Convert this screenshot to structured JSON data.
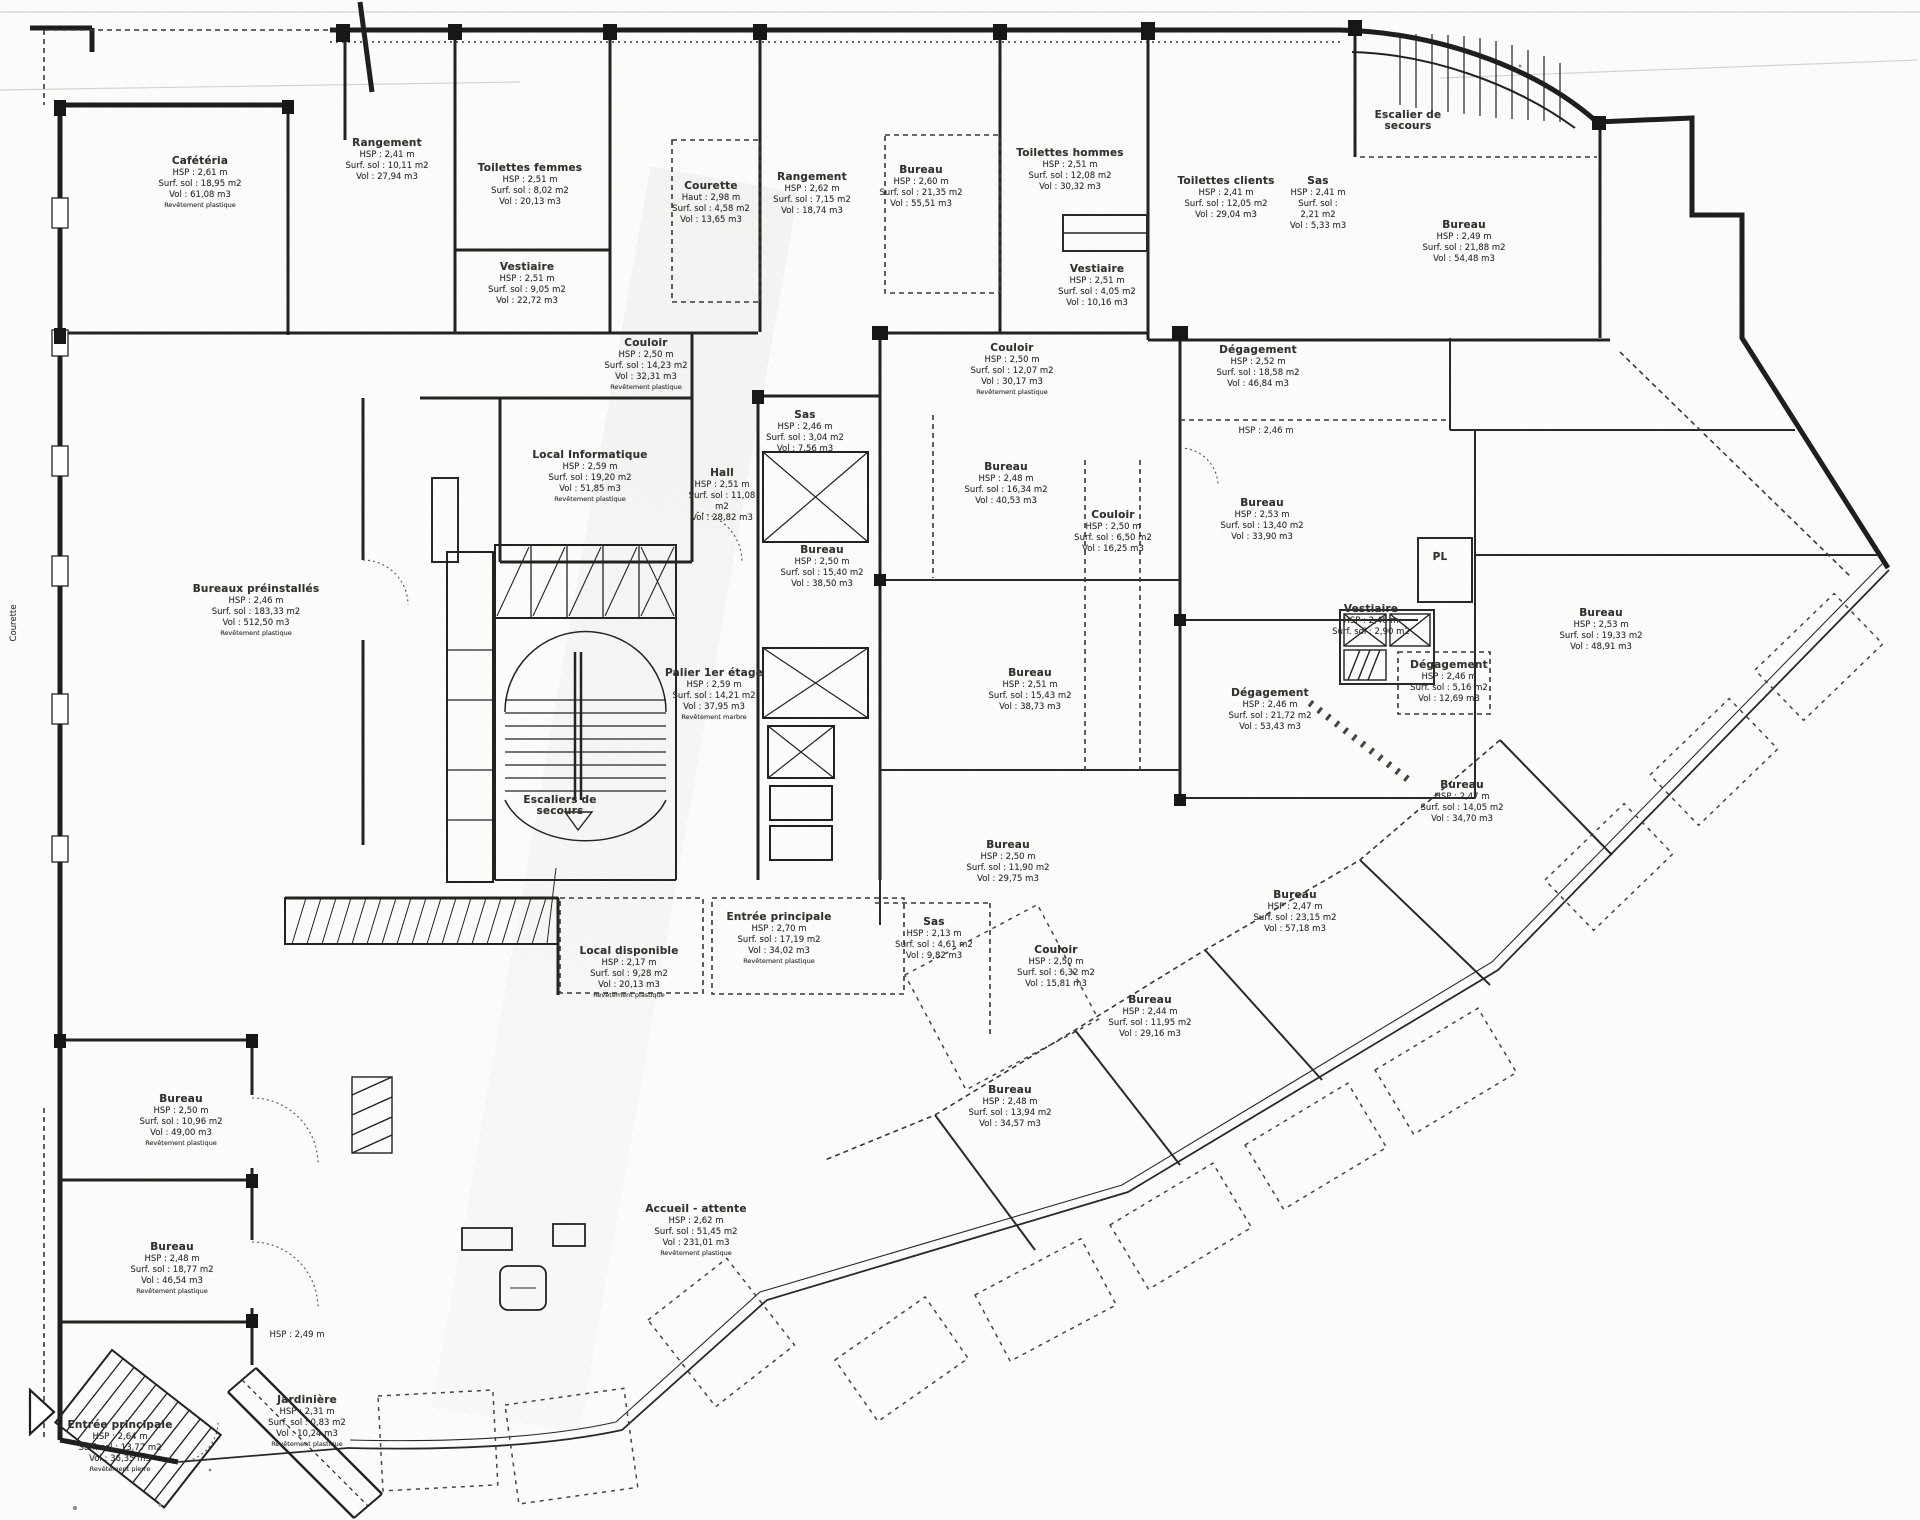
{
  "drawing": {
    "kind": "Plan d'étage scanné (1er étage)",
    "ink_color": "#201f1d",
    "paper_color": "#fcfcfa"
  },
  "rooms": [
    {
      "id": "cafeteria",
      "name": "Cafétéria",
      "lines": [
        "HSP : 2,61 m",
        "Surf. sol : 18,95 m2",
        "Vol : 61,08 m3",
        "Revêtement plastique"
      ],
      "x": 200,
      "y": 156,
      "w": 130
    },
    {
      "id": "rangement-1",
      "name": "Rangement",
      "lines": [
        "HSP : 2,41 m",
        "Surf. sol : 10,11 m2",
        "Vol : 27,94 m3"
      ],
      "x": 387,
      "y": 138,
      "w": 110
    },
    {
      "id": "toilettes-femmes",
      "name": "Toilettes femmes",
      "lines": [
        "HSP : 2,51 m",
        "Surf. sol : 8,02 m2",
        "Vol : 20,13 m3"
      ],
      "x": 530,
      "y": 163,
      "w": 125
    },
    {
      "id": "vestiaire-1",
      "name": "Vestiaire",
      "lines": [
        "HSP : 2,51 m",
        "Surf. sol : 9,05 m2",
        "Vol : 22,72 m3"
      ],
      "x": 527,
      "y": 262,
      "w": 110
    },
    {
      "id": "courette-1",
      "name": "Courette",
      "lines": [
        "Haut : 2,98 m",
        "Surf. sol : 4,58 m2",
        "Vol : 13,65 m3"
      ],
      "x": 711,
      "y": 181,
      "w": 85
    },
    {
      "id": "rangement-2",
      "name": "Rangement",
      "lines": [
        "HSP : 2,62 m",
        "Surf. sol : 7,15 m2",
        "Vol : 18,74 m3"
      ],
      "x": 812,
      "y": 172,
      "w": 100
    },
    {
      "id": "bureau-t1",
      "name": "Bureau",
      "lines": [
        "HSP : 2,60 m",
        "Surf. sol : 21,35 m2",
        "Vol : 55,51 m3"
      ],
      "x": 921,
      "y": 165,
      "w": 100
    },
    {
      "id": "toilettes-hommes",
      "name": "Toilettes hommes",
      "lines": [
        "HSP : 2,51 m",
        "Surf. sol : 12,08 m2",
        "Vol : 30,32 m3"
      ],
      "x": 1070,
      "y": 148,
      "w": 130
    },
    {
      "id": "vestiaire-2",
      "name": "Vestiaire",
      "lines": [
        "HSP : 2,51 m",
        "Surf. sol : 4,05 m2",
        "Vol : 10,16 m3"
      ],
      "x": 1097,
      "y": 264,
      "w": 90
    },
    {
      "id": "toilettes-clients",
      "name": "Toilettes clients",
      "lines": [
        "HSP : 2,41 m",
        "Surf. sol : 12,05 m2",
        "Vol : 29,04 m3"
      ],
      "x": 1226,
      "y": 176,
      "w": 120
    },
    {
      "id": "sas-1",
      "name": "Sas",
      "lines": [
        "HSP : 2,41 m",
        "Surf. sol : 2,21 m2",
        "Vol : 5,33 m3"
      ],
      "x": 1318,
      "y": 176,
      "w": 60
    },
    {
      "id": "escalier-secours",
      "name": "Escalier de secours",
      "lines": [],
      "x": 1408,
      "y": 110,
      "w": 100
    },
    {
      "id": "bureau-t2",
      "name": "Bureau",
      "lines": [
        "HSP : 2,49 m",
        "Surf. sol : 21,88 m2",
        "Vol : 54,48 m3"
      ],
      "x": 1464,
      "y": 220,
      "w": 110
    },
    {
      "id": "couloir-1",
      "name": "Couloir",
      "lines": [
        "HSP : 2,50 m",
        "Surf. sol : 14,23 m2",
        "Vol : 32,31 m3",
        "Revêtement plastique"
      ],
      "x": 646,
      "y": 338,
      "w": 110
    },
    {
      "id": "couloir-2",
      "name": "Couloir",
      "lines": [
        "HSP : 2,50 m",
        "Surf. sol : 12,07 m2",
        "Vol : 30,17 m3",
        "Revêtement plastique"
      ],
      "x": 1012,
      "y": 343,
      "w": 110
    },
    {
      "id": "degagement-1",
      "name": "Dégagement",
      "lines": [
        "HSP : 2,52 m",
        "Surf. sol : 18,58 m2",
        "Vol : 46,84 m3"
      ],
      "x": 1258,
      "y": 345,
      "w": 120
    },
    {
      "id": "local-informatique",
      "name": "Local Informatique",
      "lines": [
        "HSP : 2,59 m",
        "Surf. sol : 19,20 m2",
        "Vol : 51,85 m3",
        "Revêtement plastique"
      ],
      "x": 590,
      "y": 450,
      "w": 150
    },
    {
      "id": "hall",
      "name": "Hall",
      "lines": [
        "HSP : 2,51 m",
        "Surf. sol : 11,08 m2",
        "Vol : 28,82 m3"
      ],
      "x": 722,
      "y": 468,
      "w": 70
    },
    {
      "id": "sas-2",
      "name": "Sas",
      "lines": [
        "HSP : 2,46 m",
        "Surf. sol : 3,04 m2",
        "Vol : 7,56 m3"
      ],
      "x": 805,
      "y": 410,
      "w": 90
    },
    {
      "id": "bureau-a",
      "name": "Bureau",
      "lines": [
        "HSP : 2,48 m",
        "Surf. sol : 16,34 m2",
        "Vol : 40,53 m3"
      ],
      "x": 1006,
      "y": 462,
      "w": 110
    },
    {
      "id": "bureau-mid",
      "name": "Bureau",
      "lines": [
        "HSP : 2,50 m",
        "Surf. sol : 15,40 m2",
        "Vol : 38,50 m3"
      ],
      "x": 822,
      "y": 545,
      "w": 100
    },
    {
      "id": "bureau-c2",
      "name": "Bureau",
      "lines": [
        "HSP : 2,53 m",
        "Surf. sol : 13,40 m2",
        "Vol : 33,90 m3"
      ],
      "x": 1262,
      "y": 498,
      "w": 110
    },
    {
      "id": "couloir-3",
      "name": "Couloir",
      "lines": [
        "HSP : 2,50 m",
        "Surf. sol : 6,50 m2",
        "Vol : 16,25 m3"
      ],
      "x": 1113,
      "y": 510,
      "w": 80
    },
    {
      "id": "pl",
      "name": "PL",
      "lines": [],
      "x": 1440,
      "y": 552,
      "w": 50
    },
    {
      "id": "vestiaire-3",
      "name": "Vestiaire",
      "lines": [
        "HSP : 2,46 m",
        "Surf. sol : 2,90 m2"
      ],
      "x": 1371,
      "y": 604,
      "w": 80
    },
    {
      "id": "degagement-2",
      "name": "Dégagement",
      "lines": [
        "HSP : 2,46 m",
        "Surf. sol : 5,16 m2",
        "Vol : 12,69 m3"
      ],
      "x": 1449,
      "y": 660,
      "w": 100
    },
    {
      "id": "bureau-r1",
      "name": "Bureau",
      "lines": [
        "HSP : 2,53 m",
        "Surf. sol : 19,33 m2",
        "Vol : 48,91 m3"
      ],
      "x": 1601,
      "y": 608,
      "w": 110
    },
    {
      "id": "bureaux-preinstalles",
      "name": "Bureaux préinstallés",
      "lines": [
        "HSP : 2,46 m",
        "Surf. sol : 183,33 m2",
        "Vol : 512,50 m3",
        "Revêtement plastique"
      ],
      "x": 256,
      "y": 584,
      "w": 150
    },
    {
      "id": "palier",
      "name": "Palier 1er étage",
      "lines": [
        "HSP : 2,59 m",
        "Surf. sol : 14,21 m2",
        "Vol : 37,95 m3",
        "Revêtement marbre"
      ],
      "x": 714,
      "y": 668,
      "w": 100
    },
    {
      "id": "degagement-3",
      "name": "Dégagement",
      "lines": [
        "HSP : 2,46 m",
        "Surf. sol : 21,72 m2",
        "Vol : 53,43 m3"
      ],
      "x": 1270,
      "y": 688,
      "w": 120
    },
    {
      "id": "bureau-b",
      "name": "Bureau",
      "lines": [
        "HSP : 2,51 m",
        "Surf. sol : 15,43 m2",
        "Vol : 38,73 m3"
      ],
      "x": 1030,
      "y": 668,
      "w": 110
    },
    {
      "id": "bureau-r2",
      "name": "Bureau",
      "lines": [
        "HSP : 2,47 m",
        "Surf. sol : 14,05 m2",
        "Vol : 34,70 m3"
      ],
      "x": 1462,
      "y": 780,
      "w": 110
    },
    {
      "id": "escaliers-secours",
      "name": "Escaliers de secours",
      "lines": [],
      "x": 560,
      "y": 795,
      "w": 110
    },
    {
      "id": "bureau-f",
      "name": "Bureau",
      "lines": [
        "HSP : 2,50 m",
        "Surf. sol : 11,90 m2",
        "Vol : 29,75 m3"
      ],
      "x": 1008,
      "y": 840,
      "w": 110
    },
    {
      "id": "bureau-r3",
      "name": "Bureau",
      "lines": [
        "HSP : 2,47 m",
        "Surf. sol : 23,15 m2",
        "Vol : 57,18 m3"
      ],
      "x": 1295,
      "y": 890,
      "w": 110
    },
    {
      "id": "entree-1",
      "name": "Entrée principale",
      "lines": [
        "HSP : 2,70 m",
        "Surf. sol : 17,19 m2",
        "Vol : 34,02 m3",
        "Revêtement plastique"
      ],
      "x": 779,
      "y": 912,
      "w": 130
    },
    {
      "id": "sas-3",
      "name": "Sas",
      "lines": [
        "HSP : 2,13 m",
        "Surf. sol : 4,61 m2",
        "Vol : 9,82 m3"
      ],
      "x": 934,
      "y": 917,
      "w": 90
    },
    {
      "id": "local-disponible",
      "name": "Local disponible",
      "lines": [
        "HSP : 2,17 m",
        "Surf. sol : 9,28 m2",
        "Vol : 20,13 m3",
        "Revêtement plastique"
      ],
      "x": 629,
      "y": 946,
      "w": 130
    },
    {
      "id": "couloir-4",
      "name": "Couloir",
      "lines": [
        "HSP : 2,50 m",
        "Surf. sol : 6,32 m2",
        "Vol : 15,81 m3"
      ],
      "x": 1056,
      "y": 945,
      "w": 90
    },
    {
      "id": "bureau-d",
      "name": "Bureau",
      "lines": [
        "HSP : 2,44 m",
        "Surf. sol : 11,95 m2",
        "Vol : 29,16 m3"
      ],
      "x": 1150,
      "y": 995,
      "w": 100
    },
    {
      "id": "bureau-e",
      "name": "Bureau",
      "lines": [
        "HSP : 2,48 m",
        "Surf. sol : 13,94 m2",
        "Vol : 34,57 m3"
      ],
      "x": 1010,
      "y": 1085,
      "w": 100
    },
    {
      "id": "bureau-bl1",
      "name": "Bureau",
      "lines": [
        "HSP : 2,50 m",
        "Surf. sol : 10,96 m2",
        "Vol : 49,00 m3",
        "Revêtement plastique"
      ],
      "x": 181,
      "y": 1094,
      "w": 120
    },
    {
      "id": "bureau-bl2",
      "name": "Bureau",
      "lines": [
        "HSP : 2,48 m",
        "Surf. sol : 18,77 m2",
        "Vol : 46,54 m3",
        "Revêtement plastique"
      ],
      "x": 172,
      "y": 1242,
      "w": 120
    },
    {
      "id": "accueil",
      "name": "Accueil - attente",
      "lines": [
        "HSP : 2,62 m",
        "Surf. sol : 51,45 m2",
        "Vol : 231,01 m3",
        "Revêtement plastique"
      ],
      "x": 696,
      "y": 1204,
      "w": 130
    },
    {
      "id": "jardiniere",
      "name": "Jardinière",
      "lines": [
        "HSP : 2,31 m",
        "Surf. sol : 0,83 m2",
        "Vol : 10,24 m3",
        "Revêtement plastique"
      ],
      "x": 307,
      "y": 1395,
      "w": 110
    },
    {
      "id": "entree-2",
      "name": "Entrée principale",
      "lines": [
        "HSP : 2,64 m",
        "Surf. sol : 13,77 m2",
        "Vol : 36,35 m3",
        "Revêtement pierre"
      ],
      "x": 120,
      "y": 1420,
      "w": 125
    }
  ],
  "annotations": [
    {
      "id": "courette-side",
      "text": "Courette",
      "x": 14,
      "y": 618,
      "vertical": true
    },
    {
      "id": "hsp-note-1",
      "text": "HSP : 2,46 m",
      "x": 1266,
      "y": 426,
      "vertical": false
    },
    {
      "id": "hsp-note-2",
      "text": "HSP : 2,49 m",
      "x": 297,
      "y": 1330,
      "vertical": false
    }
  ]
}
